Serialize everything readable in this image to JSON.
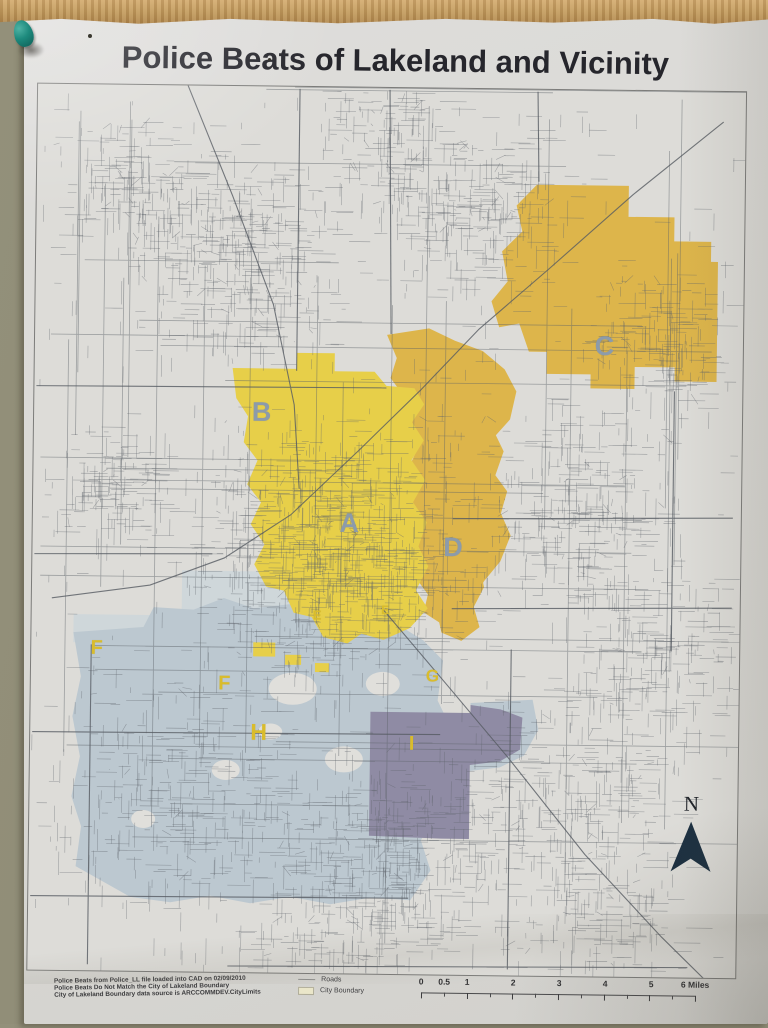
{
  "poster": {
    "title": "Police Beats of Lakeland and Vicinity"
  },
  "map": {
    "beats": [
      {
        "letter": "B",
        "x": 266,
        "y": 414,
        "size": 27,
        "color": "label_slate"
      },
      {
        "letter": "C",
        "x": 608,
        "y": 344,
        "size": 27,
        "color": "label_slate"
      },
      {
        "letter": "A",
        "x": 355,
        "y": 524,
        "size": 27,
        "color": "label_slate"
      },
      {
        "letter": "D",
        "x": 459,
        "y": 547,
        "size": 27,
        "color": "label_slate"
      },
      {
        "letter": "E",
        "x": 324,
        "y": 616,
        "size": 13,
        "color": "label_yellow"
      },
      {
        "letter": "E",
        "x": 392,
        "y": 610,
        "size": 12,
        "color": "label_yellow"
      },
      {
        "letter": "F",
        "x": 104,
        "y": 652,
        "size": 20,
        "color": "label_yellow"
      },
      {
        "letter": "F",
        "x": 232,
        "y": 686,
        "size": 20,
        "color": "label_yellow"
      },
      {
        "letter": "G",
        "x": 440,
        "y": 676,
        "size": 17,
        "color": "label_yellow"
      },
      {
        "letter": "H",
        "x": 267,
        "y": 734,
        "size": 23,
        "color": "label_yellow"
      },
      {
        "letter": "I",
        "x": 420,
        "y": 744,
        "size": 20,
        "color": "label_yellow"
      }
    ],
    "north_label": "N",
    "legend": {
      "roads": "Roads",
      "city_boundary": "City Boundary"
    },
    "scale": {
      "ticks": [
        {
          "label": "0",
          "offset": 0
        },
        {
          "label": "0.5",
          "offset": 23
        },
        {
          "label": "1",
          "offset": 46
        },
        {
          "label": "2",
          "offset": 92
        },
        {
          "label": "3",
          "offset": 138
        },
        {
          "label": "4",
          "offset": 184
        },
        {
          "label": "5",
          "offset": 230
        },
        {
          "label": "6 Miles",
          "offset": 274
        }
      ]
    },
    "notes": [
      "Police Beats from Police_LL file loaded into CAD on 02/09/2010",
      "Police Beats Do Not Match the City of Lakeland Boundary",
      "City of Lakeland Boundary data source is ARCCOMMDEV.CityLimits"
    ]
  },
  "colors": {
    "beat_yellow": "#e7cf49",
    "beat_gold": "#ddb54b",
    "beat_blue": "#bcc8d0",
    "beat_blue_light": "#cdd6da",
    "beat_purple": "#8f8ba4",
    "label_slate": "#8c9baa",
    "label_yellow": "#d9bc2c",
    "north_arrow": "#1c3041"
  }
}
